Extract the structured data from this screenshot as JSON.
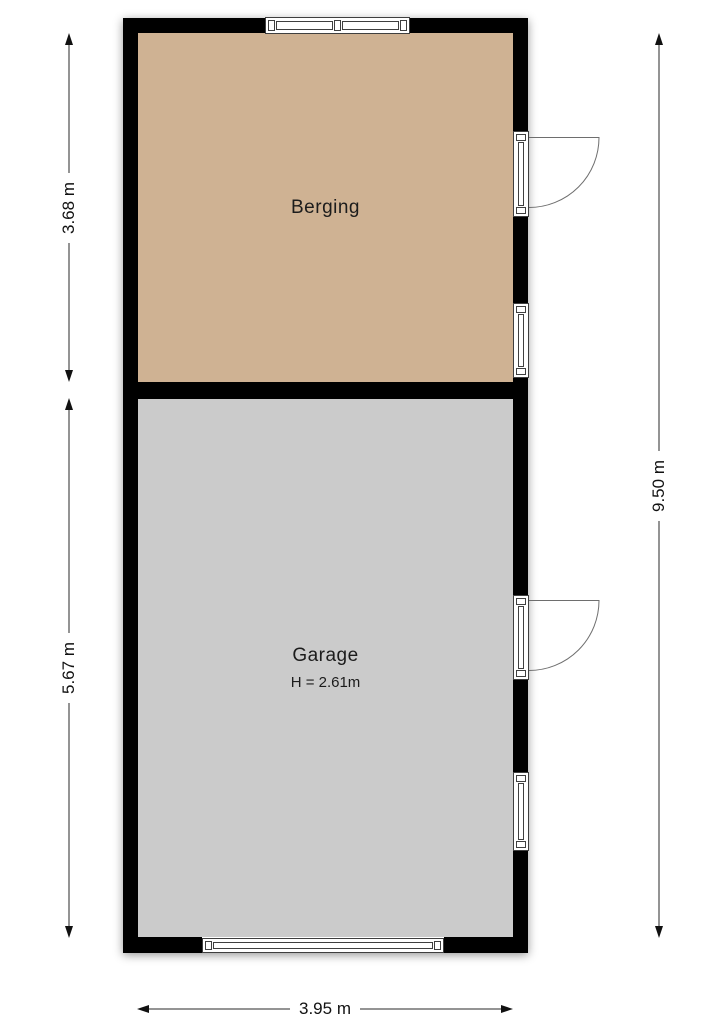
{
  "floorplan": {
    "rooms": {
      "berging": {
        "label": "Berging",
        "fill": "#cfb293"
      },
      "garage": {
        "label": "Garage",
        "height_label": "H = 2.61m",
        "fill": "#cbcbcb"
      }
    },
    "dimensions": {
      "berging_height": "3.68 m",
      "garage_height": "5.67 m",
      "total_height": "9.50 m",
      "total_width": "3.95 m"
    },
    "colors": {
      "wall": "#000000",
      "berging_fill": "#cfb293",
      "garage_fill": "#cbcbcb",
      "dimension_line": "#111111",
      "fixture_frame": "#3f3f3f",
      "door_swing": "#6e6e6e"
    }
  }
}
